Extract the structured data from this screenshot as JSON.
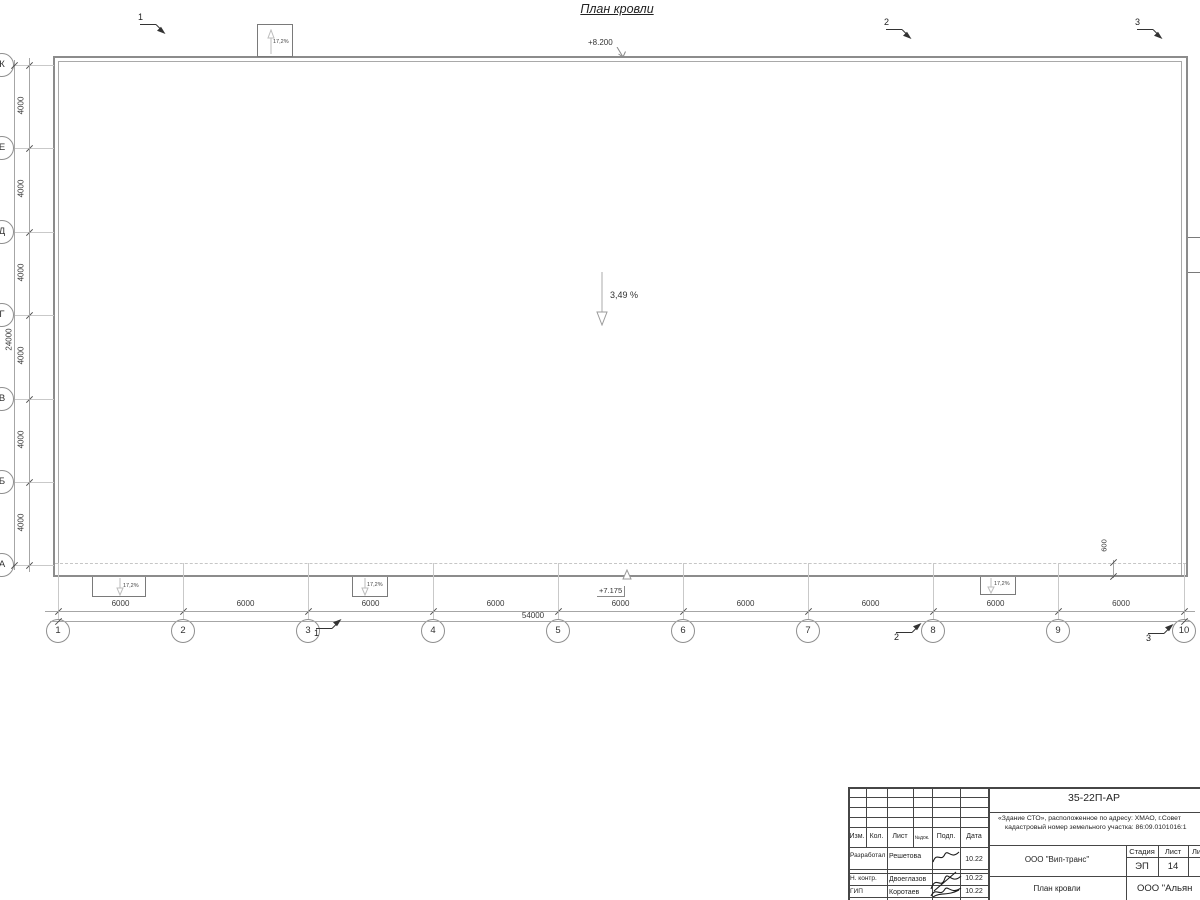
{
  "sheet_title": "План кровли",
  "plan": {
    "slope_label": "3,49 %",
    "canopy_slope": "17,2%",
    "elevation_top": "+8.200",
    "elevation_bottom": "+7.175",
    "roof_overhang": "600",
    "left_axes": [
      "К",
      "Е",
      "Д",
      "Г",
      "В",
      "Б",
      "А"
    ],
    "bottom_axes": [
      "1",
      "2",
      "3",
      "4",
      "5",
      "6",
      "7",
      "8",
      "9",
      "10"
    ],
    "left_dims": [
      "4000",
      "4000",
      "4000",
      "4000",
      "4000",
      "4000"
    ],
    "left_total": "24000",
    "bottom_dims": [
      "6000",
      "6000",
      "6000",
      "6000",
      "6000",
      "6000",
      "6000",
      "6000",
      "6000"
    ],
    "bottom_total": "54000",
    "section_marks": [
      "1",
      "2",
      "3"
    ]
  },
  "title_block": {
    "doc_number": "35-22П-АР",
    "project_line1": "«Здание СТО», расположенное по адресу: ХМАО, г.Совет",
    "project_line2": "кадастровый номер земельного участка: 86:09.0101016:1",
    "col_izm": "Изм.",
    "col_kol": "Кол.",
    "col_list": "Лист",
    "col_ndok": "№док.",
    "col_podp": "Подп.",
    "col_data": "Дата",
    "rows": [
      {
        "role": "Разработал",
        "name": "Решетова",
        "date": "10.22"
      },
      {
        "role": "Н. контр.",
        "name": "Двоеглазов",
        "date": "10.22"
      },
      {
        "role": "ГИП",
        "name": "Коротаев",
        "date": "10.22"
      }
    ],
    "company": "ООО \"Вип-транс\"",
    "stage_label": "Стадия",
    "sheet_label": "Лист",
    "sheets_label": "Листов",
    "stage_value": "ЭП",
    "sheet_value": "14",
    "drawing_title": "План кровли",
    "firm": "ООО \"Альян"
  }
}
